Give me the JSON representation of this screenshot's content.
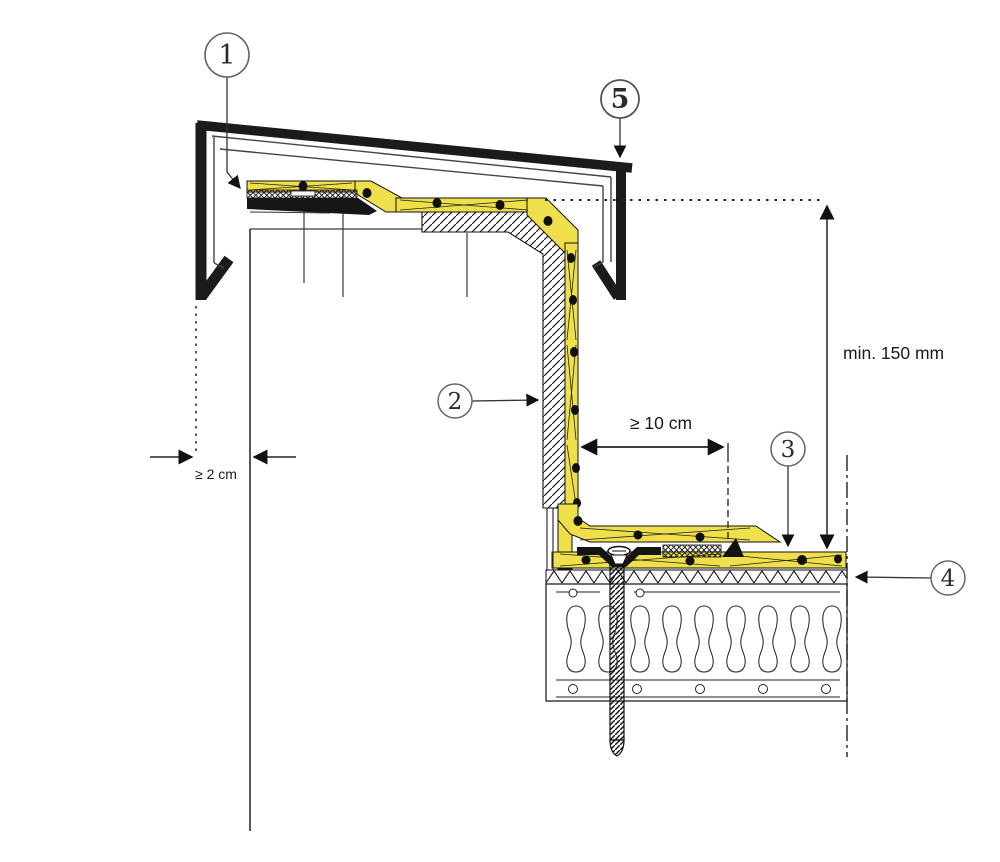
{
  "drawing": {
    "kind": "roof-parapet-construction-detail",
    "callouts": [
      {
        "number": "1"
      },
      {
        "number": "2"
      },
      {
        "number": "3"
      },
      {
        "number": "4"
      },
      {
        "number": "5"
      }
    ],
    "dimensions": {
      "height_label": "min. 150 mm",
      "overlap_label": "≥ 10 cm",
      "gap_label": "≥ 2 cm"
    },
    "colors": {
      "membrane_yellow": "#eedf4b",
      "line_black": "#1a1a1a"
    }
  }
}
